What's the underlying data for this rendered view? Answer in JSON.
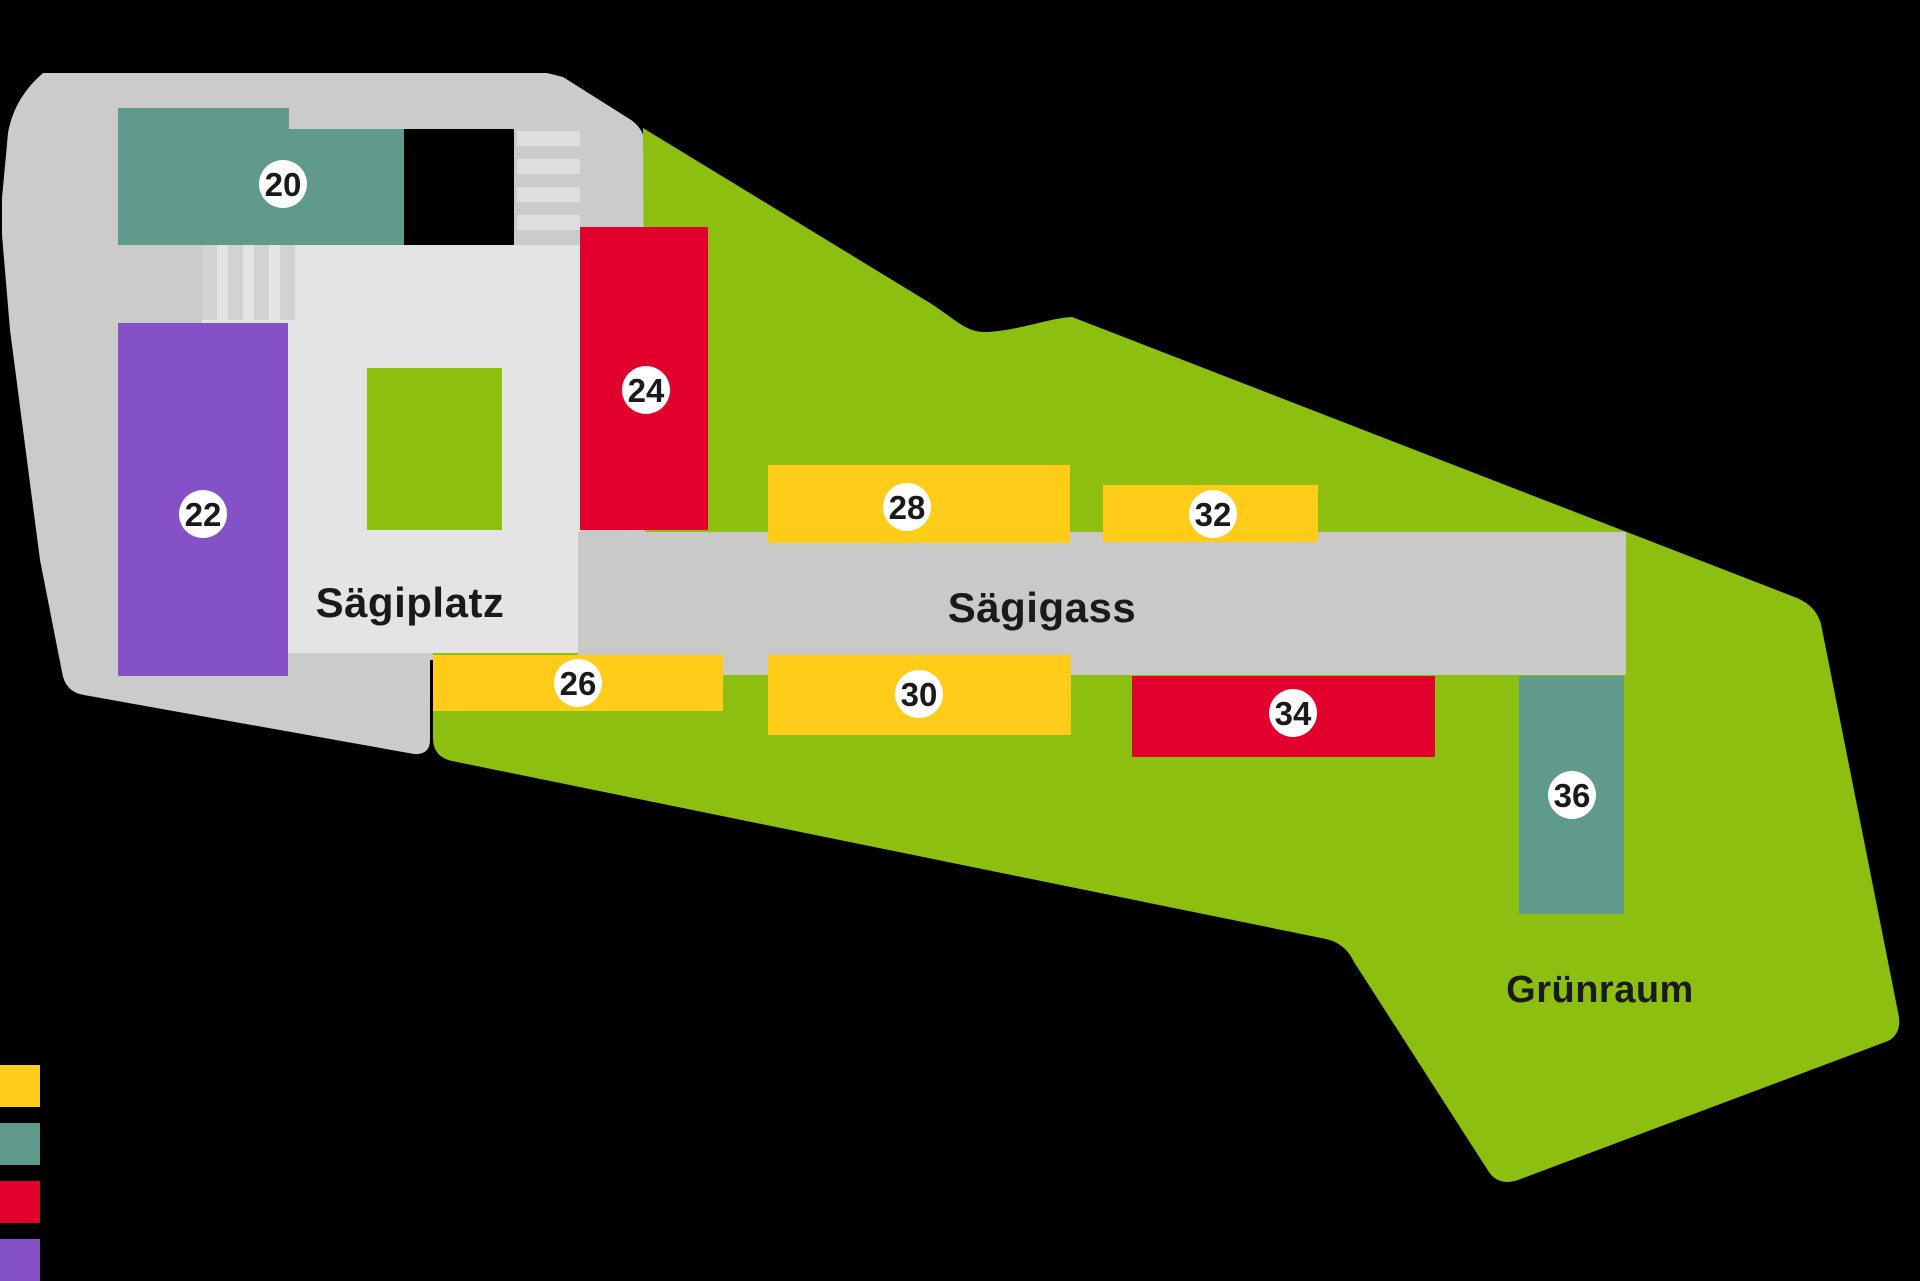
{
  "map": {
    "plaza_label": "Sägiplatz",
    "street_label": "Sägigass",
    "greenspace_label": "Grünraum"
  },
  "buildings": [
    {
      "number": "20",
      "type": "teal"
    },
    {
      "number": "22",
      "type": "purple"
    },
    {
      "number": "24",
      "type": "red"
    },
    {
      "number": "26",
      "type": "yellow"
    },
    {
      "number": "28",
      "type": "yellow"
    },
    {
      "number": "30",
      "type": "yellow"
    },
    {
      "number": "32",
      "type": "yellow"
    },
    {
      "number": "34",
      "type": "red"
    },
    {
      "number": "36",
      "type": "teal"
    }
  ],
  "legend": {
    "swatches": [
      {
        "name": "yellow",
        "color": "#FFCC1A"
      },
      {
        "name": "teal",
        "color": "#5F9A8C"
      },
      {
        "name": "red",
        "color": "#E2002C"
      },
      {
        "name": "purple",
        "color": "#8452C6"
      }
    ]
  },
  "colors": {
    "background": "#000000",
    "gray": "#CBCBCB",
    "light": "#E4E4E4",
    "road": "#C9C9C9",
    "green": "#8CBF0F",
    "teal": "#5F9A8C",
    "yellow": "#FFCC1A",
    "red": "#E2002C",
    "purple": "#8452C6",
    "black_building": "#000000",
    "stripe_light": "#DEDEDE",
    "stripe_dark": "#D2D2D2",
    "badge_bg": "#FFFFFF",
    "label": "#1A1A1A"
  }
}
